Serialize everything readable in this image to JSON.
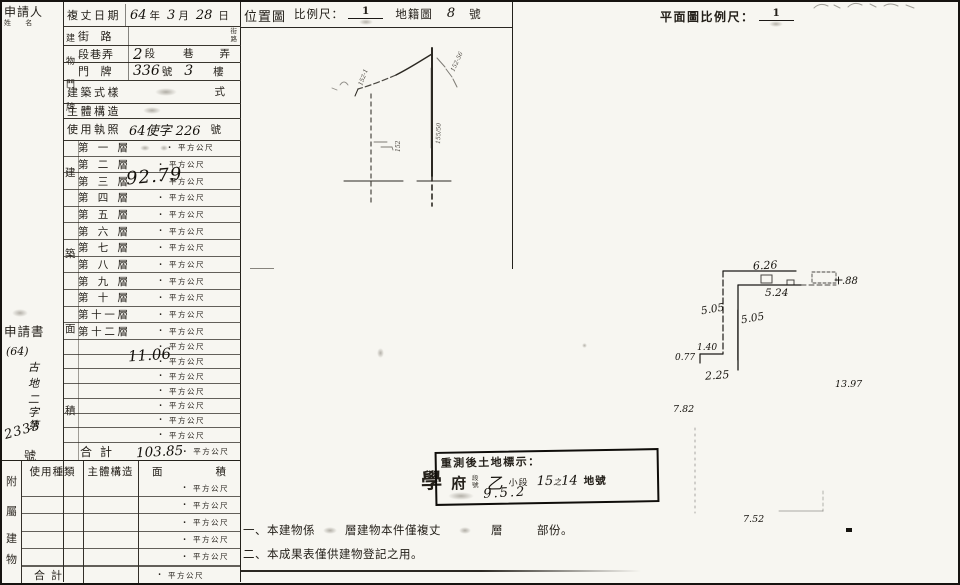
{
  "colors": {
    "paper": "#f7f6f1",
    "ink": "#24201a",
    "hand": "#14110c",
    "line": "#2c2923"
  },
  "applicant": {
    "label": "申請人",
    "sublabel": "姓 名"
  },
  "info": {
    "survey_date_label": "複丈日期",
    "survey_hw_year": "64",
    "survey_unit_year": "年",
    "survey_hw_month": "3",
    "survey_unit_month": "月",
    "survey_hw_day": "28",
    "survey_unit_day": "日",
    "group_chars": [
      "建",
      "物",
      "門",
      "牌"
    ],
    "street_label": "街 路",
    "street_side": [
      "街",
      "路"
    ],
    "section_label": "段巷弄",
    "section_hw": "2",
    "section_u1": "段",
    "section_u2": "巷",
    "section_u3": "弄",
    "house_label": "門 牌",
    "house_hw_no": "336",
    "house_unit_no": "號",
    "house_hw_floor": "3",
    "house_unit_floor": "樓",
    "style_label": "建築式樣",
    "style_unit": "式",
    "structure_label": "主體構造",
    "license_label": "使用執照",
    "license_hw": "64使字 226",
    "license_unit": "號"
  },
  "area": {
    "side_chars": [
      "建",
      "築",
      "面",
      "積"
    ],
    "floors": [
      "第一層",
      "第二層",
      "第三層",
      "第四層",
      "第五層",
      "第六層",
      "第七層",
      "第八層",
      "第九層",
      "第十層",
      "第十一層",
      "第十二層"
    ],
    "unit": "平方公尺",
    "dot": ".",
    "floor3_hw": "92.79",
    "extra_hw": "11.06",
    "extra_row_count": 7,
    "total_label": "合計",
    "total_hw": "103.85"
  },
  "application": {
    "label": "申請書",
    "hw_top": "(64)",
    "hw_chars": [
      "古",
      "地",
      "二",
      "字",
      "第"
    ],
    "hw_no": "2333",
    "suffix": "號"
  },
  "attached": {
    "side_chars": [
      "附",
      "屬",
      "建",
      "物"
    ],
    "headers": [
      "使用種類",
      "主體構造",
      "面",
      "積"
    ],
    "row_count": 5,
    "unit": "平方公尺",
    "total_label": "合計"
  },
  "location_map": {
    "title": "位置圖",
    "scale_label": "比例尺：",
    "scale_numerator": "1",
    "sheet_label": "地籍圖",
    "sheet_hw": "8",
    "sheet_unit": "號",
    "annotations": {
      "a1": "152-1",
      "a2": "152-56",
      "a3": "152",
      "a4": "155/50"
    }
  },
  "plan": {
    "title": "平面圖比例尺：",
    "scale_numerator": "1",
    "dims": {
      "top": "6.26",
      "upper": "5.24",
      "right_top": ".88",
      "left": "5.05",
      "inner": "5.05",
      "step": "1.40",
      "step_left": "0.77",
      "lower": "2.25",
      "right": "13.97",
      "left_low": "7.82",
      "bottom": "7.52"
    }
  },
  "stamp": {
    "line1": "重測後土地標示：",
    "outside": "學",
    "hw_name": "府",
    "small_top": "段",
    "small_bottom": "號",
    "hw_sub": "乙",
    "sub_label": "小段",
    "hw_lot_a": "15",
    "hw_lot_mid": "之",
    "hw_lot_b": "14",
    "lot_label": "地號",
    "hw_bldg": "9.5.2"
  },
  "notes": {
    "n1_prefix": "一、",
    "n1_a": "本建物係",
    "n1_b": "層建物本件僅複丈",
    "n1_c": "層",
    "n1_d": "部份。",
    "n2_prefix": "二、",
    "n2_text": "本成果表僅供建物登記之用。"
  }
}
